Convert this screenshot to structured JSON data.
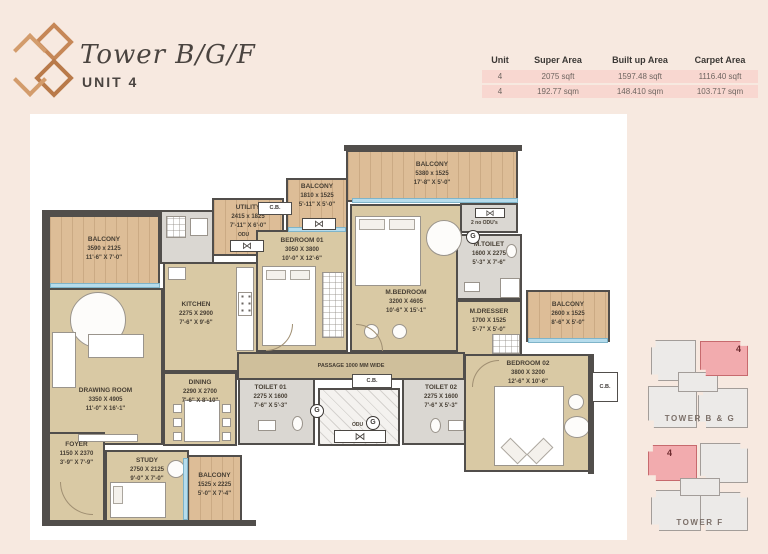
{
  "header": {
    "title": "Tower B/G/F",
    "subtitle": "UNIT 4"
  },
  "area_table": {
    "headers": [
      "Unit",
      "Super Area",
      "Built up Area",
      "Carpet Area"
    ],
    "rows": [
      [
        "4",
        "2075 sqft",
        "1597.48 sqft",
        "1116.40 sqft"
      ],
      [
        "4",
        "192.77 sqm",
        "148.410 sqm",
        "103.717 sqm"
      ]
    ]
  },
  "plan": {
    "rooms": [
      {
        "name": "BALCONY",
        "mm": "3590 x 2125",
        "ft": "11'-6\" X 7'-0\""
      },
      {
        "name": "UTILITY",
        "mm": "2415 x 1825",
        "ft": "7'-11\" X 6'-0\""
      },
      {
        "name": "BALCONY",
        "mm": "1810 x 1525",
        "ft": "5'-11\" X 5'-0\""
      },
      {
        "name": "BALCONY",
        "mm": "5380 x 1525",
        "ft": "17'-8\" X 5'-0\""
      },
      {
        "name": "BEDROOM 01",
        "mm": "3050 X 3800",
        "ft": "10'-0\" X 12'-6\""
      },
      {
        "name": "M.BEDROOM",
        "mm": "3200 X 4605",
        "ft": "10'-6\" X 15'-1\""
      },
      {
        "name": "M.TOILET",
        "mm": "1600 X 2275",
        "ft": "5'-3\" X 7'-6\""
      },
      {
        "name": "M.DRESSER",
        "mm": "1700 X 1525",
        "ft": "5'-7\" X 5'-0\""
      },
      {
        "name": "BALCONY",
        "mm": "2600 x 1525",
        "ft": "8'-6\" X 5'-0\""
      },
      {
        "name": "KITCHEN",
        "mm": "2275 X 2900",
        "ft": "7'-6\" X 9'-6\""
      },
      {
        "name": "DRAWING ROOM",
        "mm": "3350 X 4905",
        "ft": "11'-0\" X 16'-1\""
      },
      {
        "name": "DINING",
        "mm": "2290 X 2700",
        "ft": "7'-6\" X 8'-10\""
      },
      {
        "name": "FOYER",
        "mm": "1150 X 2370",
        "ft": "3'-9\" X 7'-9\""
      },
      {
        "name": "STUDY",
        "mm": "2750 X 2125",
        "ft": "9'-0\" X 7'-0\""
      },
      {
        "name": "BALCONY",
        "mm": "1525 x 2225",
        "ft": "5'-0\" X 7'-4\""
      },
      {
        "name": "TOILET 01",
        "mm": "2275 X 1600",
        "ft": "7'-6\" X 5'-3\""
      },
      {
        "name": "TOILET 02",
        "mm": "2275 X 1600",
        "ft": "7'-6\" X 5'-3\""
      },
      {
        "name": "BEDROOM 02",
        "mm": "3800 X 3200",
        "ft": "12'-6\" X 10'-6\""
      }
    ],
    "passage_label": "PASSAGE 1000 MM WIDE",
    "labels": {
      "cb": "C.B.",
      "odu": "ODU",
      "two_odu": "2 no ODU's",
      "geyser": "G"
    }
  },
  "icons": {
    "odu_fan": "⋈"
  },
  "keyplans": [
    {
      "label": "TOWER B & G",
      "unit": "4"
    },
    {
      "label": "TOWER F",
      "unit": "4"
    }
  ],
  "colors": {
    "accent_copper": "#c68757",
    "table_row_pink": "#f8d7d0",
    "keyplan_pink": "#f2abae",
    "floor_beige": "#d9c9a4",
    "balcony_wood": "#ddbd97",
    "wall": "#514e4b",
    "glazing_blue": "#b6dcec"
  }
}
